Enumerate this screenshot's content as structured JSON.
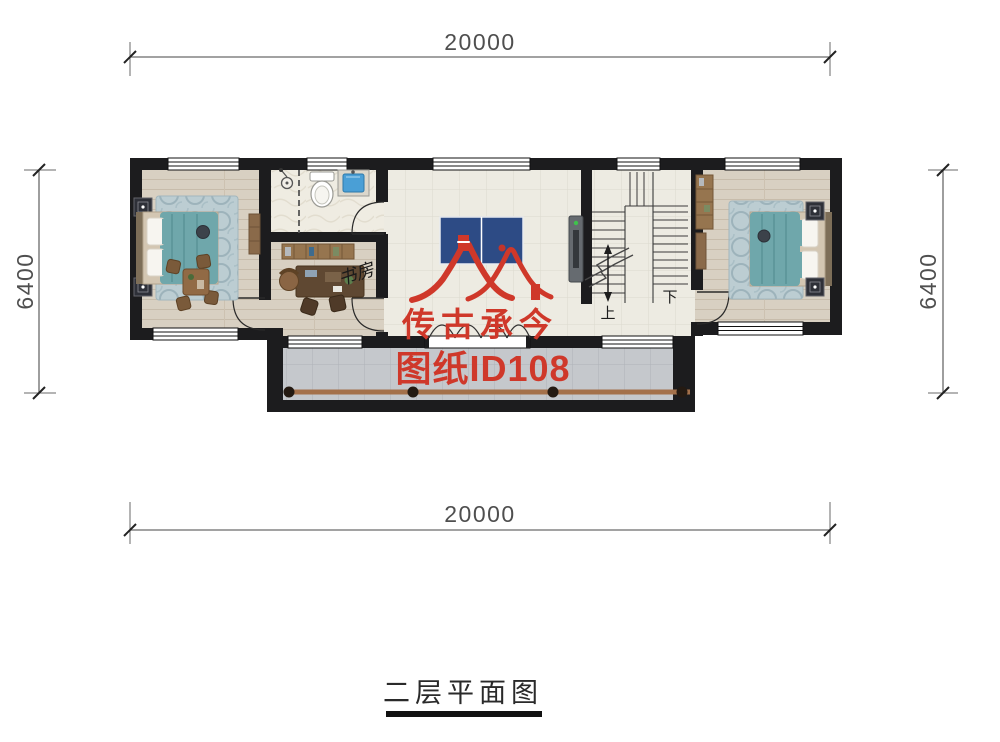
{
  "plan": {
    "title": "二层平面图",
    "dimensions": {
      "top": "20000",
      "bottom": "20000",
      "left": "6400",
      "right": "6400"
    },
    "labels": {
      "study": "书房",
      "stairs_up": "上",
      "stairs_down": "下"
    },
    "watermark": {
      "brand": "传古承今",
      "sheet_id": "图纸ID108",
      "color": "#cf382a"
    },
    "colors": {
      "wall": "#1c1c1e",
      "wood_floor": "#d8d0c2",
      "tile_floor": "#edebe2",
      "balcony_tile": "#c5c8cc",
      "bedding_teal": "#6fa7ab",
      "pingpong_blue": "#2d4b85",
      "sink_blue": "#4a9fd6",
      "railing_brown": "#a4714b",
      "watermark_red": "#cf382a"
    },
    "icons": [
      "double-bed-icon",
      "rug-icon",
      "nightstand-icon",
      "tea-table-icon",
      "chair-icon",
      "toilet-icon",
      "sink-icon",
      "shower-icon",
      "desk-icon",
      "bookshelf-icon",
      "office-chair-icon",
      "wardrobe-icon",
      "dresser-icon",
      "ping-pong-table-icon",
      "wall-tv-icon",
      "staircase-icon",
      "stair-direction-arrow-icon",
      "balcony-railing-icon",
      "door-swing-icon",
      "folding-door-icon",
      "window-icon",
      "roof-logo-icon",
      "dimension-tick-icon"
    ]
  }
}
